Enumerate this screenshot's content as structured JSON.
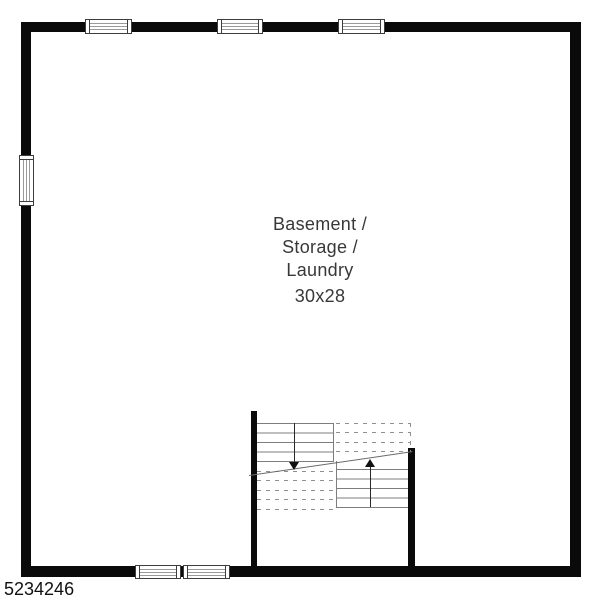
{
  "room": {
    "label_line1": "Basement /",
    "label_line2": "Storage /",
    "label_line3": "Laundry",
    "dimensions": "30x28"
  },
  "footer": {
    "listing_number": "5234246"
  },
  "colors": {
    "wall": "#0a0a0a",
    "tread_line": "#7d7d7d",
    "dashed_tread_line": "#8f8f8f",
    "window_frame": "#3d3d3d",
    "window_glazing": "#9a9a9a",
    "label_text": "#383838",
    "background": "#ffffff"
  }
}
